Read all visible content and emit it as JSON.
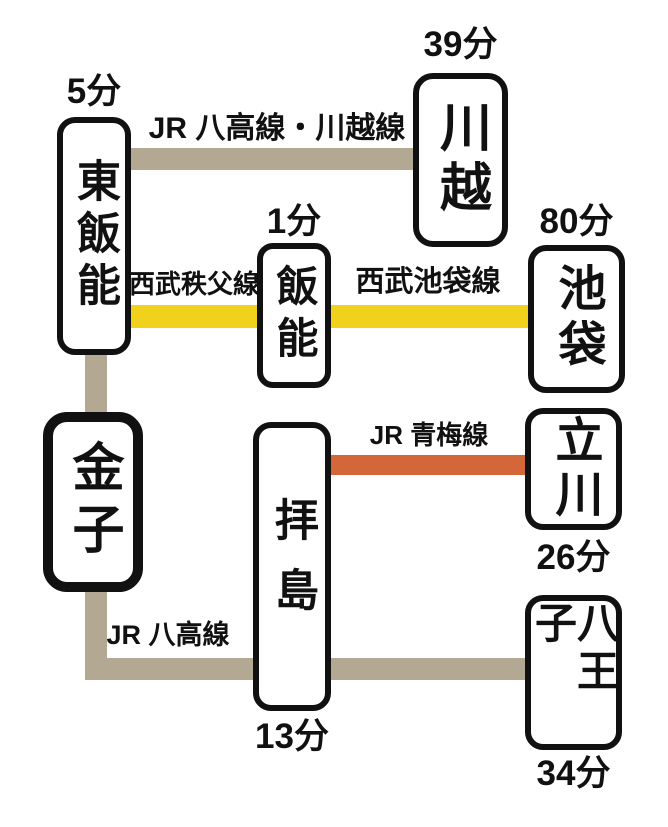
{
  "diagram": {
    "stations": {
      "higashi_hanno": {
        "name": "東飯能",
        "time": "5分"
      },
      "kawagoe": {
        "name": "川越",
        "time": "39分"
      },
      "hanno": {
        "name": "飯能",
        "time": "1分"
      },
      "ikebukuro": {
        "name": "池袋",
        "time": "80分"
      },
      "kaneko": {
        "name": "金子"
      },
      "haijima": {
        "name": "拝島",
        "time": "13分"
      },
      "tachikawa": {
        "name": "立川",
        "time": "26分"
      },
      "hachioji": {
        "name": "八王子",
        "time": "34分"
      }
    },
    "lines": {
      "jr_hachiko_kawagoe": {
        "label": "JR 八高線・川越線",
        "color": "#b3a892"
      },
      "seibu_chichibu": {
        "label": "西武秩父線",
        "color": "#f0d11c"
      },
      "seibu_ikebukuro": {
        "label": "西武池袋線",
        "color": "#f0d11c"
      },
      "jr_ome": {
        "label": "JR 青梅線",
        "color": "#d4673a"
      },
      "jr_hachiko": {
        "label": "JR 八高線",
        "color": "#b3a892"
      }
    },
    "colors": {
      "jr_gray": "#b3a892",
      "seibu_yellow": "#f0d11c",
      "ome_orange": "#d4673a",
      "box_border": "#111111",
      "background": "#ffffff"
    }
  }
}
